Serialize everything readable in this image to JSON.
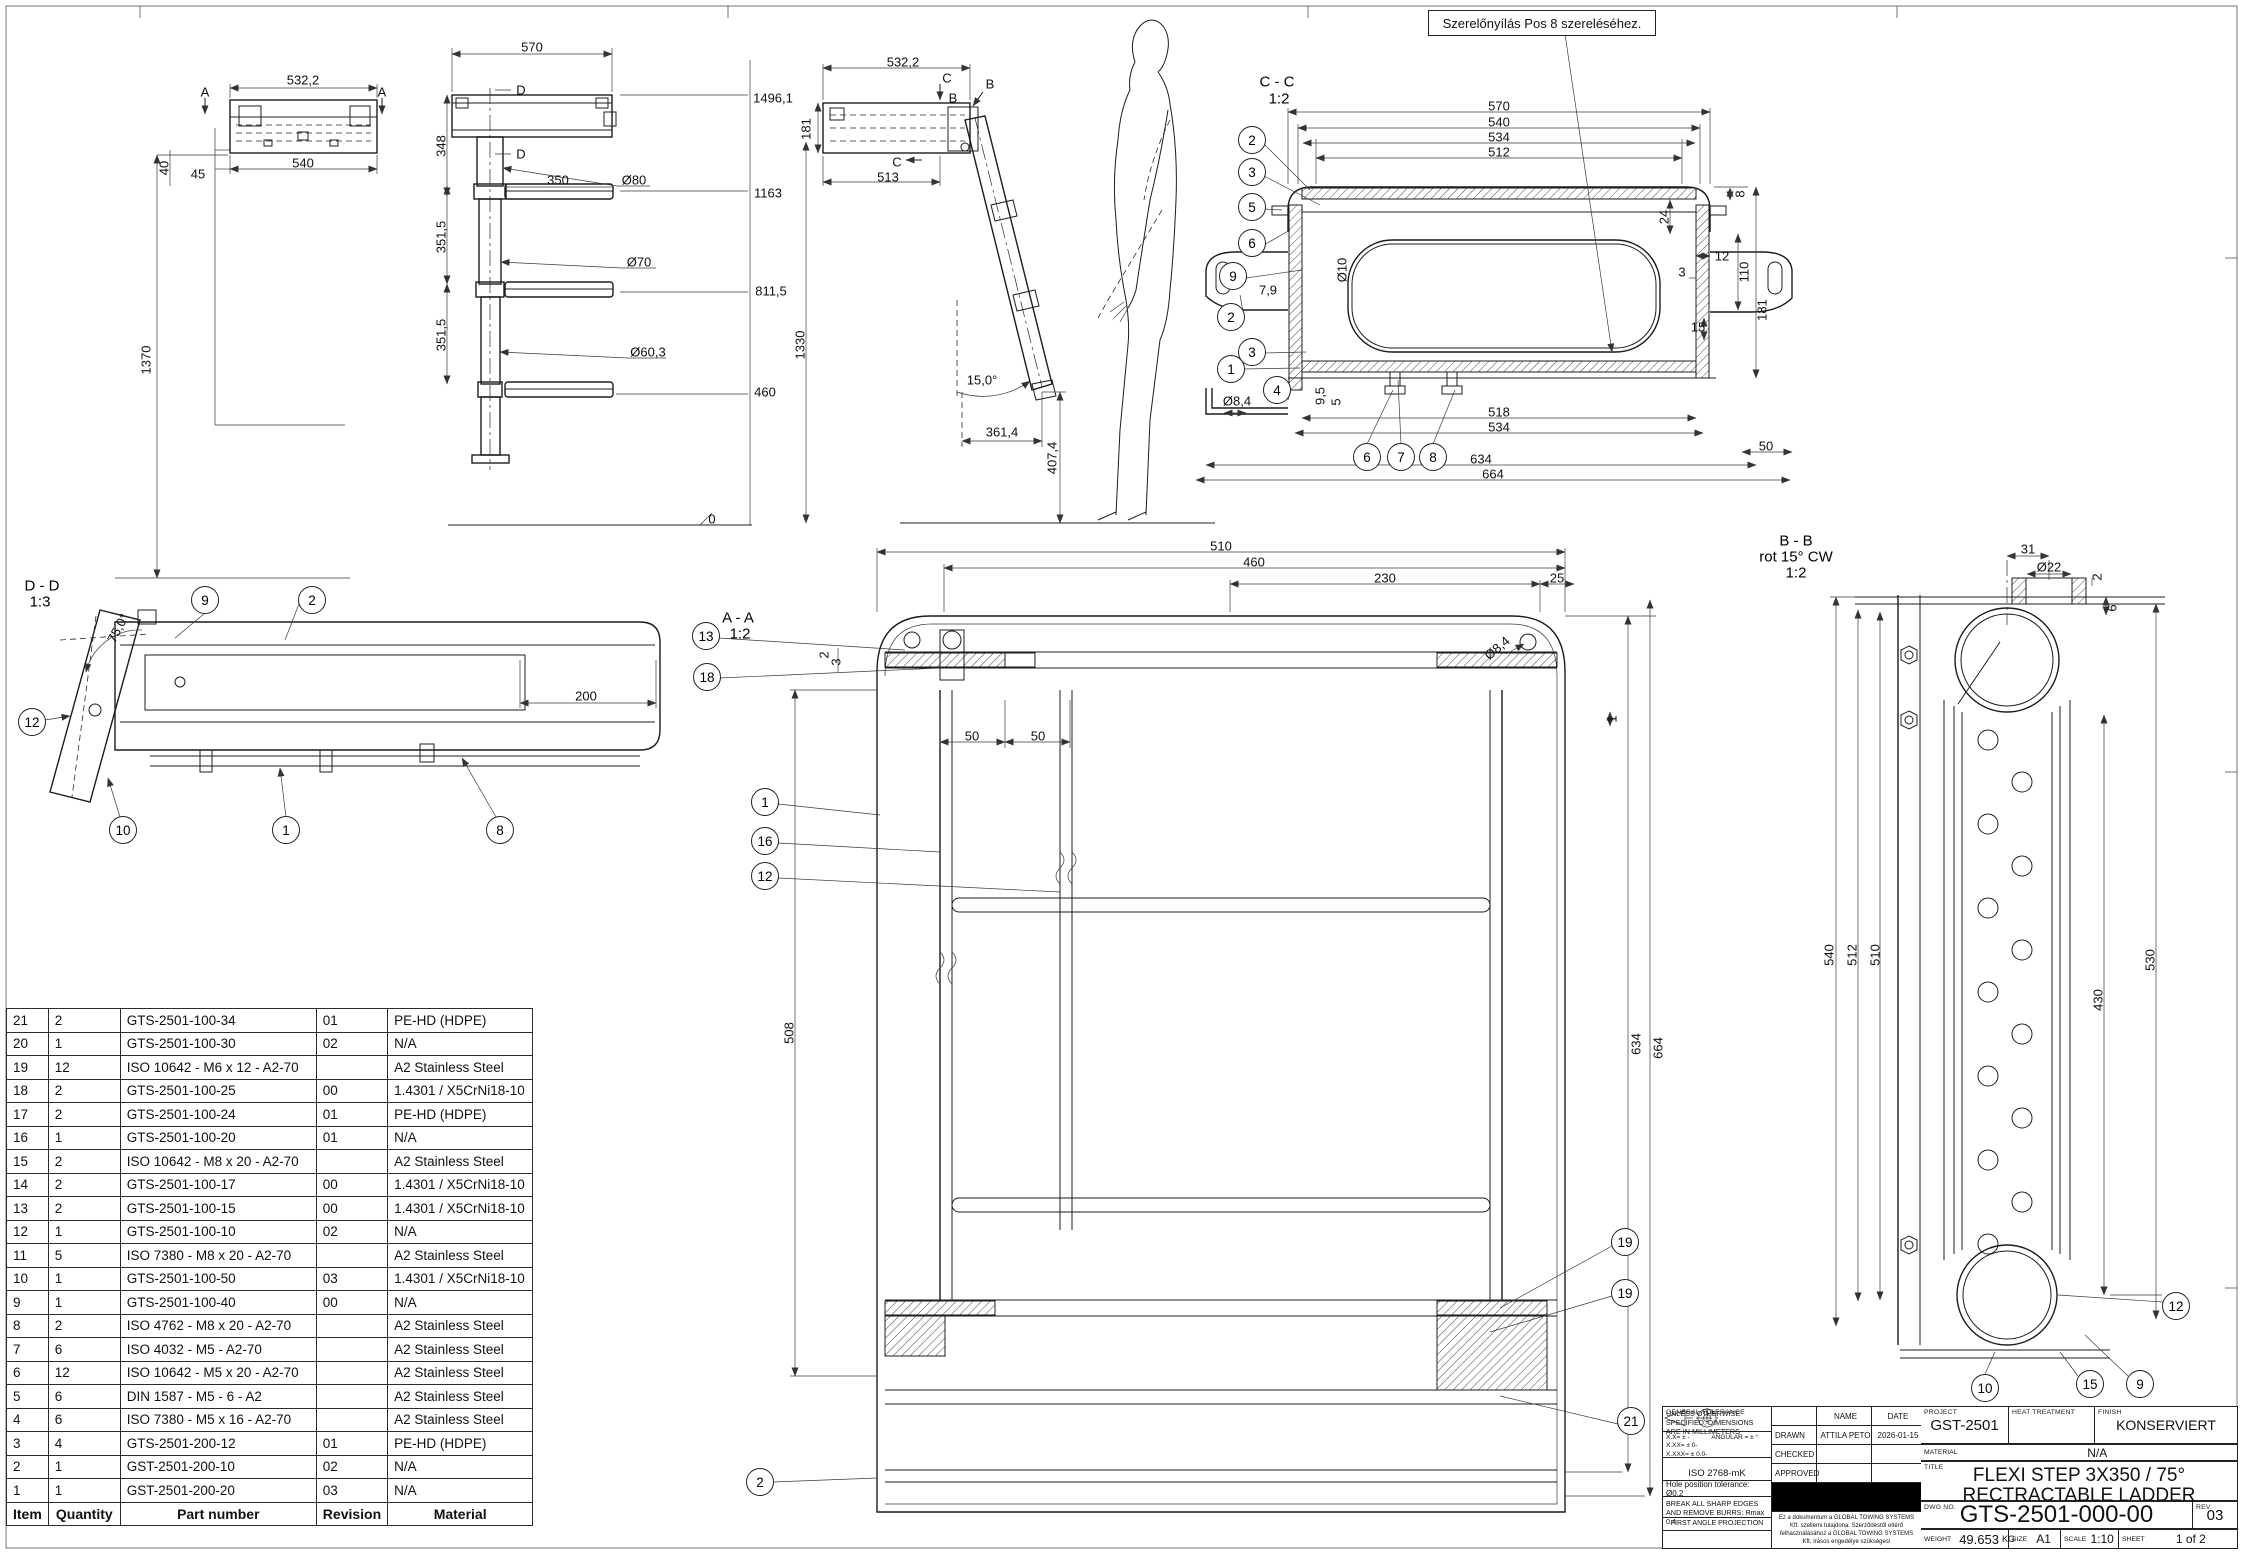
{
  "annotation": {
    "text": "Szerelőnyílás Pos 8 szereléséhez."
  },
  "bom": {
    "headers": [
      "Item",
      "Quantity",
      "Part number",
      "Revision",
      "Material"
    ],
    "rows": [
      [
        "21",
        "2",
        "GTS-2501-100-34",
        "01",
        "PE-HD (HDPE)"
      ],
      [
        "20",
        "1",
        "GTS-2501-100-30",
        "02",
        "N/A"
      ],
      [
        "19",
        "12",
        "ISO 10642 - M6 x 12 - A2-70",
        "",
        "A2 Stainless Steel"
      ],
      [
        "18",
        "2",
        "GTS-2501-100-25",
        "00",
        "1.4301 / X5CrNi18-10"
      ],
      [
        "17",
        "2",
        "GTS-2501-100-24",
        "01",
        "PE-HD (HDPE)"
      ],
      [
        "16",
        "1",
        "GTS-2501-100-20",
        "01",
        "N/A"
      ],
      [
        "15",
        "2",
        "ISO 10642 - M8 x 20 - A2-70",
        "",
        "A2 Stainless Steel"
      ],
      [
        "14",
        "2",
        "GTS-2501-100-17",
        "00",
        "1.4301 / X5CrNi18-10"
      ],
      [
        "13",
        "2",
        "GTS-2501-100-15",
        "00",
        "1.4301 / X5CrNi18-10"
      ],
      [
        "12",
        "1",
        "GTS-2501-100-10",
        "02",
        "N/A"
      ],
      [
        "11",
        "5",
        "ISO 7380 - M8 x 20 - A2-70",
        "",
        "A2 Stainless Steel"
      ],
      [
        "10",
        "1",
        "GTS-2501-100-50",
        "03",
        "1.4301 / X5CrNi18-10"
      ],
      [
        "9",
        "1",
        "GTS-2501-100-40",
        "00",
        "N/A"
      ],
      [
        "8",
        "2",
        "ISO 4762 - M8 x 20 - A2-70",
        "",
        "A2 Stainless Steel"
      ],
      [
        "7",
        "6",
        "ISO 4032 - M5 - A2-70",
        "",
        "A2 Stainless Steel"
      ],
      [
        "6",
        "12",
        "ISO 10642 - M5 x 20 - A2-70",
        "",
        "A2 Stainless Steel"
      ],
      [
        "5",
        "6",
        "DIN 1587 - M5 - 6 - A2",
        "",
        "A2 Stainless Steel"
      ],
      [
        "4",
        "6",
        "ISO 7380 - M5 x 16 - A2-70",
        "",
        "A2 Stainless Steel"
      ],
      [
        "3",
        "4",
        "GTS-2501-200-12",
        "01",
        "PE-HD (HDPE)"
      ],
      [
        "2",
        "1",
        "GST-2501-200-10",
        "02",
        "N/A"
      ],
      [
        "1",
        "1",
        "GST-2501-200-20",
        "03",
        "N/A"
      ]
    ]
  },
  "title_block": {
    "general": {
      "units_note": "UNLESS OTHERWISE SPECIFIED, DIMENSIONS ARE IN MILLIMETERS",
      "tol1": "X.X= ± -",
      "tol2": "X.XX= ± 0-",
      "tol3": "X.XXX= ± 0.0-",
      "tol_angular": "ANGULAR = ± °",
      "general_tolerance_label": "GENERAL TOLERANCE",
      "general_tolerance": "ISO 2768-mK",
      "hole_tolerance": "Hole position tolerance: Ø0.2",
      "deburr": "BREAK ALL SHARP EDGES AND REMOVE BURRS: Rmax 0.4",
      "projection": "FIRST ANGLE PROJECTION"
    },
    "signoff": {
      "name_label": "NAME",
      "date_label": "DATE",
      "drawn_label": "DRAWN",
      "drawn_name": "ATTILA PETO",
      "drawn_date": "2026-01-15",
      "checked_label": "CHECKED",
      "approved_label": "APPROVED",
      "ownership": "Ez a dokumentum a GLOBAL TOWING SYSTEMS Kft. szellemi tulajdona. Szerződéstől eltérő felhasználásához a GLOBAL TOWING SYSTEMS Kft. írásos engedélye szükséges!"
    },
    "project_label": "PROJECT",
    "project": "GST-2501",
    "heat_label": "HEAT TREATMENT",
    "heat": "",
    "finish_label": "FINISH",
    "finish": "KONSERVIERT",
    "material_label": "MATERIAL",
    "material": "N/A",
    "title_label": "TITLE",
    "title_line1": "FLEXI STEP 3X350 / 75°",
    "title_line2": "RECTRACTABLE LADDER",
    "dwg_label": "DWG NO.",
    "dwg_no": "GTS-2501-000-00",
    "rev_label": "REV.",
    "rev": "03",
    "weight_label": "WEIGHT",
    "weight": "49.653",
    "weight_unit": "KG",
    "size_label": "SIZE",
    "size": "A1",
    "scale_label": "SCALE",
    "scale": "1:10",
    "sheet_label": "SHEET",
    "sheet": "1 of 2"
  },
  "drawing": {
    "labels": [
      {
        "t": "532,2",
        "x": 303,
        "y": 80
      },
      {
        "t": "A",
        "x": 205,
        "y": 92
      },
      {
        "t": "A",
        "x": 382,
        "y": 92
      },
      {
        "t": "540",
        "x": 303,
        "y": 163
      },
      {
        "t": "45",
        "x": 198,
        "y": 174
      },
      {
        "t": "40",
        "x": 164,
        "y": 168,
        "r": -90
      },
      {
        "t": "1370",
        "x": 146,
        "y": 360,
        "r": -90
      },
      {
        "t": "570",
        "x": 532,
        "y": 47
      },
      {
        "t": "348",
        "x": 441,
        "y": 146,
        "r": -90
      },
      {
        "t": "D",
        "x": 521,
        "y": 90
      },
      {
        "t": "D",
        "x": 521,
        "y": 154
      },
      {
        "t": "350",
        "x": 558,
        "y": 180
      },
      {
        "t": "Ø80",
        "x": 634,
        "y": 180
      },
      {
        "t": "351,5",
        "x": 441,
        "y": 237,
        "r": -90
      },
      {
        "t": "Ø70",
        "x": 639,
        "y": 262
      },
      {
        "t": "351,5",
        "x": 441,
        "y": 335,
        "r": -90
      },
      {
        "t": "Ø60,3",
        "x": 648,
        "y": 352
      },
      {
        "t": "1496,1",
        "x": 773,
        "y": 98
      },
      {
        "t": "1163",
        "x": 768,
        "y": 193
      },
      {
        "t": "811,5",
        "x": 771,
        "y": 291
      },
      {
        "t": "460",
        "x": 765,
        "y": 392
      },
      {
        "t": "1330",
        "x": 800,
        "y": 345,
        "r": -90
      },
      {
        "t": "0",
        "x": 712,
        "y": 519
      },
      {
        "t": "532,2",
        "x": 903,
        "y": 62
      },
      {
        "t": "C",
        "x": 947,
        "y": 78
      },
      {
        "t": "B",
        "x": 990,
        "y": 84
      },
      {
        "t": "B",
        "x": 953,
        "y": 98
      },
      {
        "t": "C",
        "x": 897,
        "y": 162
      },
      {
        "t": "513",
        "x": 888,
        "y": 177
      },
      {
        "t": "181",
        "x": 806,
        "y": 129,
        "r": -90
      },
      {
        "t": "15,0°",
        "x": 982,
        "y": 380
      },
      {
        "t": "361,4",
        "x": 1002,
        "y": 432
      },
      {
        "t": "407,4",
        "x": 1052,
        "y": 458,
        "r": -90
      },
      {
        "t": "570",
        "x": 1499,
        "y": 106
      },
      {
        "t": "540",
        "x": 1499,
        "y": 122
      },
      {
        "t": "534",
        "x": 1499,
        "y": 137
      },
      {
        "t": "512",
        "x": 1499,
        "y": 152
      },
      {
        "t": "8",
        "x": 1740,
        "y": 194,
        "r": -90
      },
      {
        "t": "24",
        "x": 1664,
        "y": 217,
        "r": -90
      },
      {
        "t": "12",
        "x": 1722,
        "y": 256
      },
      {
        "t": "3",
        "x": 1682,
        "y": 272
      },
      {
        "t": "110",
        "x": 1744,
        "y": 272,
        "r": -90
      },
      {
        "t": "181",
        "x": 1762,
        "y": 310,
        "r": -90
      },
      {
        "t": "15",
        "x": 1698,
        "y": 327
      },
      {
        "t": "Ø10",
        "x": 1342,
        "y": 270,
        "r": -90
      },
      {
        "t": "7,9",
        "x": 1268,
        "y": 290
      },
      {
        "t": "Ø8,4",
        "x": 1237,
        "y": 401
      },
      {
        "t": "9,5",
        "x": 1320,
        "y": 396,
        "r": -90
      },
      {
        "t": "5",
        "x": 1336,
        "y": 402,
        "r": -90
      },
      {
        "t": "518",
        "x": 1499,
        "y": 412
      },
      {
        "t": "534",
        "x": 1499,
        "y": 427
      },
      {
        "t": "634",
        "x": 1481,
        "y": 459
      },
      {
        "t": "664",
        "x": 1493,
        "y": 474
      },
      {
        "t": "50",
        "x": 1766,
        "y": 446
      },
      {
        "t": "510",
        "x": 1221,
        "y": 546
      },
      {
        "t": "460",
        "x": 1254,
        "y": 562
      },
      {
        "t": "230",
        "x": 1385,
        "y": 578
      },
      {
        "t": "25",
        "x": 1557,
        "y": 578
      },
      {
        "t": "Ø8,4",
        "x": 1497,
        "y": 648,
        "r": -40
      },
      {
        "t": "2",
        "x": 824,
        "y": 655,
        "r": -90
      },
      {
        "t": "3",
        "x": 836,
        "y": 662,
        "r": -90
      },
      {
        "t": "50",
        "x": 972,
        "y": 736
      },
      {
        "t": "50",
        "x": 1038,
        "y": 736
      },
      {
        "t": "1",
        "x": 1612,
        "y": 719,
        "r": -90
      },
      {
        "t": "508",
        "x": 789,
        "y": 1033,
        "r": -90
      },
      {
        "t": "634",
        "x": 1636,
        "y": 1044,
        "r": -90
      },
      {
        "t": "664",
        "x": 1658,
        "y": 1048,
        "r": -90
      },
      {
        "t": "31",
        "x": 2028,
        "y": 549
      },
      {
        "t": "Ø22",
        "x": 2049,
        "y": 567
      },
      {
        "t": "2",
        "x": 2097,
        "y": 577,
        "r": -90
      },
      {
        "t": "6",
        "x": 2112,
        "y": 608,
        "r": -90
      },
      {
        "t": "540",
        "x": 1829,
        "y": 955,
        "r": -90
      },
      {
        "t": "512",
        "x": 1852,
        "y": 955,
        "r": -90
      },
      {
        "t": "510",
        "x": 1875,
        "y": 955,
        "r": -90
      },
      {
        "t": "430",
        "x": 2098,
        "y": 1000,
        "r": -90
      },
      {
        "t": "530",
        "x": 2150,
        "y": 960,
        "r": -90
      },
      {
        "t": "200",
        "x": 586,
        "y": 696
      },
      {
        "t": "75,0°",
        "x": 118,
        "y": 628,
        "r": -62
      },
      {
        "t": "D - D",
        "x": 42,
        "y": 586,
        "cls": "vt"
      },
      {
        "t": "1:3",
        "x": 40,
        "y": 602,
        "cls": "vt"
      },
      {
        "t": "A - A",
        "x": 738,
        "y": 618,
        "cls": "vt"
      },
      {
        "t": "1:2",
        "x": 740,
        "y": 634,
        "cls": "vt"
      },
      {
        "t": "C - C",
        "x": 1277,
        "y": 82,
        "cls": "vt"
      },
      {
        "t": "1:2",
        "x": 1279,
        "y": 99,
        "cls": "vt"
      },
      {
        "t": "B - B",
        "x": 1796,
        "y": 541,
        "cls": "vt"
      },
      {
        "t": "rot 15° CW",
        "x": 1796,
        "y": 557,
        "cls": "vt"
      },
      {
        "t": "1:2",
        "x": 1796,
        "y": 573,
        "cls": "vt"
      }
    ],
    "balloons": [
      {
        "n": "9",
        "x": 205,
        "y": 600
      },
      {
        "n": "2",
        "x": 312,
        "y": 600
      },
      {
        "n": "12",
        "x": 32,
        "y": 722
      },
      {
        "n": "10",
        "x": 123,
        "y": 830
      },
      {
        "n": "1",
        "x": 286,
        "y": 830
      },
      {
        "n": "8",
        "x": 500,
        "y": 830
      },
      {
        "n": "2",
        "x": 1252,
        "y": 140
      },
      {
        "n": "3",
        "x": 1252,
        "y": 172
      },
      {
        "n": "5",
        "x": 1252,
        "y": 207
      },
      {
        "n": "6",
        "x": 1252,
        "y": 243
      },
      {
        "n": "9",
        "x": 1233,
        "y": 276
      },
      {
        "n": "2",
        "x": 1231,
        "y": 317
      },
      {
        "n": "3",
        "x": 1252,
        "y": 352
      },
      {
        "n": "1",
        "x": 1231,
        "y": 369
      },
      {
        "n": "4",
        "x": 1277,
        "y": 390
      },
      {
        "n": "6",
        "x": 1367,
        "y": 457
      },
      {
        "n": "7",
        "x": 1401,
        "y": 457
      },
      {
        "n": "8",
        "x": 1433,
        "y": 457
      },
      {
        "n": "13",
        "x": 706,
        "y": 636
      },
      {
        "n": "18",
        "x": 707,
        "y": 677
      },
      {
        "n": "1",
        "x": 765,
        "y": 802
      },
      {
        "n": "16",
        "x": 765,
        "y": 841
      },
      {
        "n": "12",
        "x": 765,
        "y": 876
      },
      {
        "n": "19",
        "x": 1625,
        "y": 1242
      },
      {
        "n": "19",
        "x": 1625,
        "y": 1293
      },
      {
        "n": "21",
        "x": 1631,
        "y": 1421
      },
      {
        "n": "2",
        "x": 760,
        "y": 1482
      },
      {
        "n": "10",
        "x": 1985,
        "y": 1388
      },
      {
        "n": "15",
        "x": 2090,
        "y": 1384
      },
      {
        "n": "9",
        "x": 2140,
        "y": 1384
      },
      {
        "n": "12",
        "x": 2176,
        "y": 1306
      }
    ]
  }
}
